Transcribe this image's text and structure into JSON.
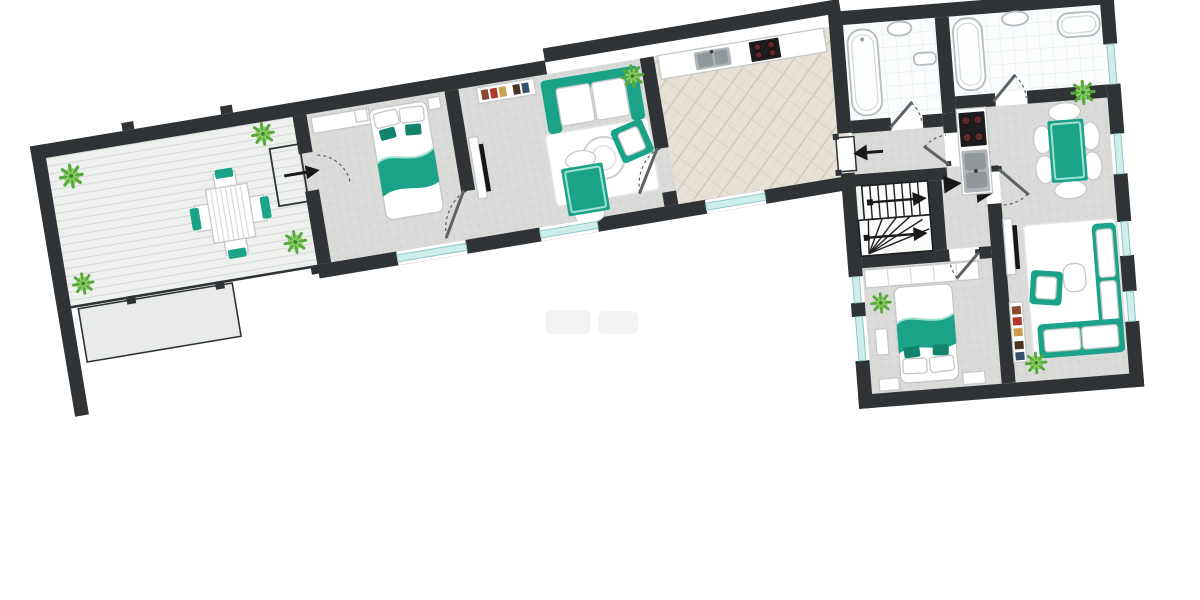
{
  "meta": {
    "kind": "apartment floor plan rendering",
    "view": "top-down 3D render, plan rotated diagonally",
    "text_labels": [],
    "bedrooms": 2,
    "bathrooms": 2,
    "door_swings": 8,
    "direction_arrows": 5
  },
  "palette": {
    "wall": "#2f3335",
    "floor": "#dadbd9",
    "floor_dot": "#cbccca",
    "deck": "#eef0ee",
    "deck_line": "#d5d8d5",
    "parquet": "#e7e1d7",
    "parquet_line": "#d0c7b9",
    "tile": "#fbfcfd",
    "tile_line": "#e1e7e8",
    "teal": "#1aa388",
    "teal_dark": "#12836d",
    "teal_light": "#9fe0d1",
    "glass": "#cdeeea",
    "glass_edge": "#8fc7c0",
    "plant": "#58a93c",
    "plant_light": "#8bcf63",
    "plant_dark": "#3e7f2b",
    "steel": "#aeb4b7",
    "basin": "#90989c",
    "stove": "#1d1d1f",
    "burner": "#5a2a2c",
    "annex": "#e9ebe9",
    "furn_edge": "#c5c8c7",
    "leaf": "#5d6264",
    "arrowc": "#17191a",
    "book_colors": [
      "#8a4a2f",
      "#b03a2e",
      "#caa04a",
      "#4a3322",
      "#39506b"
    ]
  },
  "left_wing": {
    "rotation_deg": -9.5,
    "rooms": [
      {
        "name": "terrace",
        "floor": "wood deck planks",
        "furniture": [
          "outdoor dining table with slats",
          "4 chairs with teal pads",
          "4 potted plants",
          "railing",
          "entry vestibule with arrow into bedroom",
          "lower annex roof below"
        ]
      },
      {
        "name": "bedroom-1",
        "floor": "light grey",
        "furniture": [
          "double bed with teal blanket and 2 teal cushions",
          "white dresser",
          "2 nightstands",
          "window"
        ]
      },
      {
        "name": "living-room-1",
        "floor": "light grey",
        "furniture": [
          "bookshelf with colored books",
          "teal-frame sofa with white cushions",
          "white rug",
          "round coffee table",
          "teal armchair",
          "teal dining table with 2 white chairs",
          "plant",
          "wall TV on white panel",
          "window"
        ]
      },
      {
        "name": "hall-kitchen",
        "floor": "herringbone parquet",
        "furniture": [
          "kitchen counter with steel sink and black 4-burner stove",
          "window"
        ]
      }
    ]
  },
  "right_block": {
    "rotation_deg": -4.5,
    "rooms": [
      {
        "name": "bathroom-1",
        "floor": "white tile grid",
        "furniture": [
          "bathtub",
          "washbasin",
          "towel radiator",
          "door with swing"
        ]
      },
      {
        "name": "bathroom-2",
        "floor": "white tile grid",
        "furniture": [
          "bathtub",
          "wall washbasin",
          "small second tub",
          "door with swing"
        ]
      },
      {
        "name": "corridor-and-stairwell",
        "floor": "light grey / white stairwell",
        "furniture": [
          "entrance door with black arrow",
          "staircase with two flights and direction arrows",
          "2 black direction triangles"
        ]
      },
      {
        "name": "kitchen-dining-living",
        "floor": "light grey",
        "furniture": [
          "counter with black stove and steel double sink",
          "teal dining table with 6 white chairs",
          "plant",
          "wall TV on white panel",
          "bookshelf",
          "white rug",
          "teal corner sofa with white cushions",
          "teal armchair",
          "white coffee table",
          "plant"
        ]
      },
      {
        "name": "bedroom-2",
        "floor": "light grey",
        "furniture": [
          "wardrobe strip",
          "double bed with teal blanket, pillows at foot wall",
          "2 nightstands",
          "bench",
          "plant",
          "2 windows"
        ]
      }
    ]
  },
  "windows": {
    "left_wing": 3,
    "right_block_right_wall": 4,
    "right_block_left_wall": 2
  },
  "watermark": "faint illegible grey smudge below plan"
}
